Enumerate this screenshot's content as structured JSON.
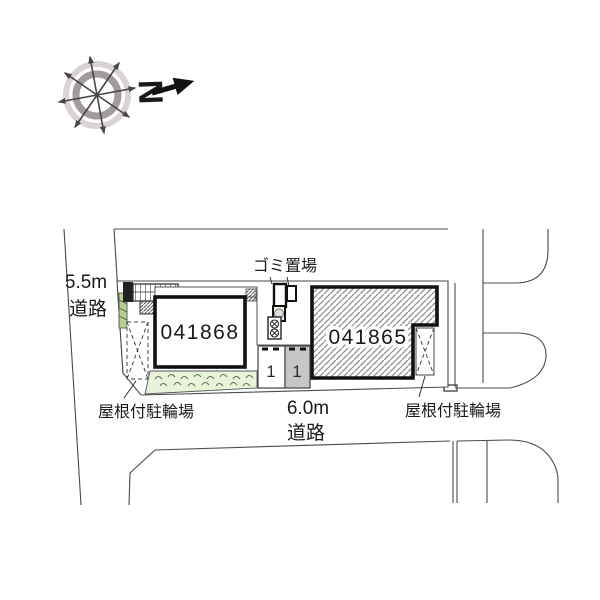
{
  "figure": {
    "type": "site-plan",
    "description_labels": {
      "garbage_label": "ゴミ置場",
      "bike_left_label": "屋根付駐輪場",
      "bike_right_label": "屋根付駐輪場"
    }
  },
  "compass": {
    "north_label": "N"
  },
  "roads": {
    "west": {
      "width_label": "5.5m",
      "type_label": "道路"
    },
    "south": {
      "width_label": "6.0m",
      "type_label": "道路"
    }
  },
  "site": {
    "buildings": [
      {
        "id": "041868",
        "fill": "plain"
      },
      {
        "id": "041865",
        "fill": "diagonal-hatch"
      }
    ],
    "parking_spaces": [
      {
        "number": "1",
        "fill": "#ffffff"
      },
      {
        "number": "1",
        "fill": "#c6c6c6"
      }
    ]
  },
  "colors": {
    "line": "#4a4a4a",
    "building_border": "#111111",
    "hatch": "#8f8f8f",
    "planting_fill": "#e9f3da",
    "planting_stroke": "#64744d",
    "hedge_fill": "#b7cf92",
    "stall_gray": "#c6c6c6",
    "compass_outer_ring": "#d9d3d3",
    "compass_inner_ring": "#a39b9b",
    "compass_arrow": "#4a4446"
  }
}
